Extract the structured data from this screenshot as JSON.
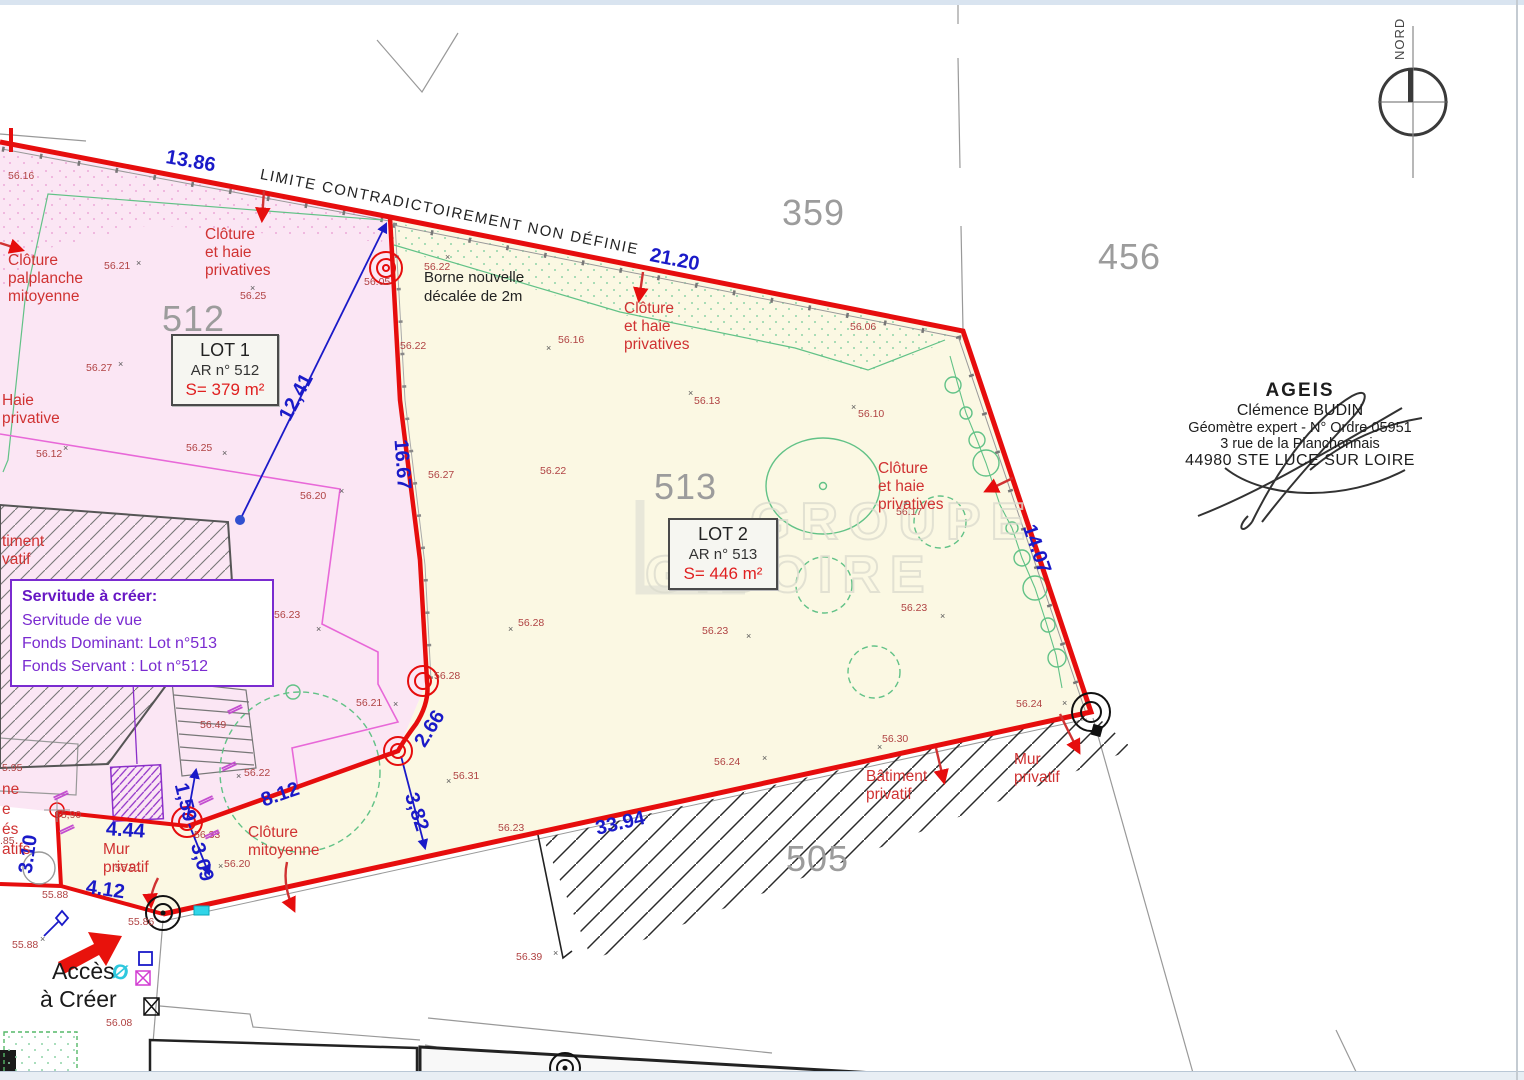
{
  "page": {
    "limit_label": "LIMITE CONTRADICTOIREMENT NON DÉFINIE",
    "north_label": "NORD"
  },
  "watermark": {
    "line1": "GROUPE",
    "line2": "GIBOIRE"
  },
  "lot1": {
    "title": "LOT 1",
    "ref": "AR n° 512",
    "area": "S= 379 m²"
  },
  "lot2": {
    "title": "LOT 2",
    "ref": "AR n° 513",
    "area": "S= 446 m²"
  },
  "servitude": {
    "title": "Servitude à créer:",
    "line1": "Servitude de vue",
    "line2": "Fonds Dominant: Lot n°513",
    "line3": "Fonds Servant : Lot n°512"
  },
  "stamp": {
    "line1": "AGEIS",
    "line2": "Clémence BUDIN",
    "line3": "Géomètre expert - N° Ordre 05951",
    "line4": "3 rue de la Planchonnais",
    "line5": "44980 STE LUCE SUR LOIRE"
  },
  "access": {
    "line1": "Accès",
    "line2": "à Créer",
    "symbol": "Ø"
  },
  "borne_note": {
    "text": "Borne nouvelle\ndécalée de 2m"
  },
  "parcel_numbers": [
    {
      "x": 782,
      "y": 192,
      "text": "359"
    },
    {
      "x": 1098,
      "y": 236,
      "text": "456"
    },
    {
      "x": 162,
      "y": 298,
      "text": "512"
    },
    {
      "x": 654,
      "y": 466,
      "text": "513"
    },
    {
      "x": 786,
      "y": 838,
      "text": "505"
    }
  ],
  "dimensions": [
    {
      "x": 166,
      "y": 146,
      "rot": 10,
      "text": "13.86"
    },
    {
      "x": 650,
      "y": 244,
      "rot": 11,
      "text": "21.20"
    },
    {
      "x": 285,
      "y": 408,
      "rot": -62,
      "text": "12,41"
    },
    {
      "x": 400,
      "y": 428,
      "rot": 86,
      "text": "16.67"
    },
    {
      "x": 1028,
      "y": 514,
      "rot": 71,
      "text": "14.07"
    },
    {
      "x": 420,
      "y": 734,
      "rot": -58,
      "text": "2.66"
    },
    {
      "x": 410,
      "y": 782,
      "rot": 72,
      "text": "3,82"
    },
    {
      "x": 262,
      "y": 790,
      "rot": -19,
      "text": "8.12"
    },
    {
      "x": 106,
      "y": 818,
      "rot": 4,
      "text": "4.44"
    },
    {
      "x": 86,
      "y": 876,
      "rot": 8,
      "text": "4.12"
    },
    {
      "x": 26,
      "y": 862,
      "rot": -82,
      "text": "3.10"
    },
    {
      "x": 180,
      "y": 772,
      "rot": 76,
      "text": "1,59"
    },
    {
      "x": 196,
      "y": 832,
      "rot": 74,
      "text": "3,09"
    },
    {
      "x": 596,
      "y": 818,
      "rot": -13,
      "text": "33.94"
    }
  ],
  "feature_labels": [
    {
      "x": 205,
      "y": 226,
      "text": "Clôture et haie\nprivatives"
    },
    {
      "x": 8,
      "y": 252,
      "text": "Clôture\npalplanche\nmitoyenne"
    },
    {
      "x": 2,
      "y": 392,
      "text": "Haie privative"
    },
    {
      "x": 624,
      "y": 300,
      "text": "Clôture et haie\nprivatives"
    },
    {
      "x": 878,
      "y": 460,
      "text": "Clôture et haie\nprivatives"
    },
    {
      "x": 248,
      "y": 824,
      "text": "Clôture\nmitoyenne"
    },
    {
      "x": 103,
      "y": 841,
      "text": "Mur\nprivatif"
    },
    {
      "x": 1014,
      "y": 751,
      "text": "Mur privatif"
    },
    {
      "x": 866,
      "y": 768,
      "text": "Bâtiment\nprivatif"
    },
    {
      "x": 2,
      "y": 533,
      "text": "timent\nvatif"
    },
    {
      "x": 2,
      "y": 781,
      "text": "ne"
    },
    {
      "x": 2,
      "y": 801,
      "text": "e"
    },
    {
      "x": 2,
      "y": 821,
      "text": "és"
    },
    {
      "x": 2,
      "y": 841,
      "text": "atifs"
    }
  ],
  "spot_elevations": [
    {
      "x": 8,
      "y": 170,
      "text": "56.16"
    },
    {
      "x": 104,
      "y": 260,
      "text": "56.21"
    },
    {
      "x": 240,
      "y": 290,
      "text": "56.25"
    },
    {
      "x": 86,
      "y": 362,
      "text": "56.27"
    },
    {
      "x": 36,
      "y": 448,
      "text": "56.12"
    },
    {
      "x": 186,
      "y": 442,
      "text": "56.25"
    },
    {
      "x": 300,
      "y": 490,
      "text": "56.20"
    },
    {
      "x": 274,
      "y": 609,
      "text": "56.23"
    },
    {
      "x": 200,
      "y": 719,
      "text": "56.49"
    },
    {
      "x": 244,
      "y": 767,
      "text": "56.22"
    },
    {
      "x": 356,
      "y": 697,
      "text": "56.21"
    },
    {
      "x": 424,
      "y": 261,
      "text": "56.22"
    },
    {
      "x": 400,
      "y": 340,
      "text": "56.22"
    },
    {
      "x": 428,
      "y": 469,
      "text": "56.27"
    },
    {
      "x": 540,
      "y": 465,
      "text": "56.22"
    },
    {
      "x": 558,
      "y": 334,
      "text": "56.16"
    },
    {
      "x": 694,
      "y": 395,
      "text": "56.13"
    },
    {
      "x": 858,
      "y": 408,
      "text": "56.10"
    },
    {
      "x": 850,
      "y": 321,
      "text": "56.06"
    },
    {
      "x": 364,
      "y": 276,
      "text": "56.05"
    },
    {
      "x": 896,
      "y": 506,
      "text": "56.17"
    },
    {
      "x": 901,
      "y": 602,
      "text": "56.23"
    },
    {
      "x": 518,
      "y": 617,
      "text": "56.28"
    },
    {
      "x": 702,
      "y": 625,
      "text": "56.23"
    },
    {
      "x": 434,
      "y": 670,
      "text": "56.28"
    },
    {
      "x": 453,
      "y": 770,
      "text": "56.31"
    },
    {
      "x": 498,
      "y": 822,
      "text": "56.23"
    },
    {
      "x": 714,
      "y": 756,
      "text": "56.24"
    },
    {
      "x": 882,
      "y": 733,
      "text": "56.30"
    },
    {
      "x": 1016,
      "y": 698,
      "text": "56.24"
    },
    {
      "x": 194,
      "y": 829,
      "text": "56.33"
    },
    {
      "x": 115,
      "y": 862,
      "text": "55.91"
    },
    {
      "x": 55,
      "y": 809,
      "text": "55,90"
    },
    {
      "x": 42,
      "y": 889,
      "text": "55.88"
    },
    {
      "x": 12,
      "y": 939,
      "text": "55.88"
    },
    {
      "x": 128,
      "y": 916,
      "text": "55.86"
    },
    {
      "x": 106,
      "y": 1017,
      "text": "56.08"
    },
    {
      "x": 516,
      "y": 951,
      "text": "56.39"
    },
    {
      "x": 2,
      "y": 762,
      "text": "5.95"
    },
    {
      "x": 0,
      "y": 835,
      "text": ".85"
    },
    {
      "x": 224,
      "y": 858,
      "text": "56.20"
    }
  ],
  "x_marks": [
    {
      "x": 136,
      "y": 258,
      "text": "×"
    },
    {
      "x": 250,
      "y": 283,
      "text": "×"
    },
    {
      "x": 118,
      "y": 359,
      "text": "×"
    },
    {
      "x": 222,
      "y": 448,
      "text": "×"
    },
    {
      "x": 339,
      "y": 486,
      "text": "×"
    },
    {
      "x": 316,
      "y": 624,
      "text": "×"
    },
    {
      "x": 393,
      "y": 699,
      "text": "×"
    },
    {
      "x": 445,
      "y": 252,
      "text": "×"
    },
    {
      "x": 546,
      "y": 343,
      "text": "×"
    },
    {
      "x": 688,
      "y": 388,
      "text": "×"
    },
    {
      "x": 851,
      "y": 402,
      "text": "×"
    },
    {
      "x": 903,
      "y": 498,
      "text": "×"
    },
    {
      "x": 940,
      "y": 611,
      "text": "×"
    },
    {
      "x": 508,
      "y": 624,
      "text": "×"
    },
    {
      "x": 746,
      "y": 631,
      "text": "×"
    },
    {
      "x": 446,
      "y": 776,
      "text": "×"
    },
    {
      "x": 762,
      "y": 753,
      "text": "×"
    },
    {
      "x": 877,
      "y": 742,
      "text": "×"
    },
    {
      "x": 1062,
      "y": 698,
      "text": "×"
    },
    {
      "x": 40,
      "y": 934,
      "text": "×"
    },
    {
      "x": 553,
      "y": 948,
      "text": "×"
    },
    {
      "x": 218,
      "y": 861,
      "text": "×"
    },
    {
      "x": 63,
      "y": 443,
      "text": "×"
    },
    {
      "x": 236,
      "y": 771,
      "text": "×"
    }
  ],
  "fence_symbols": [
    {
      "x": 58,
      "y": 786,
      "rot": 65,
      "text": "∥"
    },
    {
      "x": 64,
      "y": 820,
      "rot": 65,
      "text": "∥"
    },
    {
      "x": 203,
      "y": 791,
      "rot": 65,
      "text": "∥"
    },
    {
      "x": 209,
      "y": 825,
      "rot": 65,
      "text": "∥"
    },
    {
      "x": 226,
      "y": 757,
      "rot": 65,
      "text": "∥"
    },
    {
      "x": 232,
      "y": 700,
      "rot": 65,
      "text": "∥"
    }
  ],
  "colors": {
    "boundary_red": "#e60d0d",
    "dimension_blue": "#1a1ac8",
    "label_red": "#d03232",
    "spot_red": "#b04343",
    "parcel_gray": "#9c9c9c",
    "servitude_purple": "#7a2bd0",
    "hedge_green": "#62c287",
    "fence_magenta": "#e868d8"
  }
}
